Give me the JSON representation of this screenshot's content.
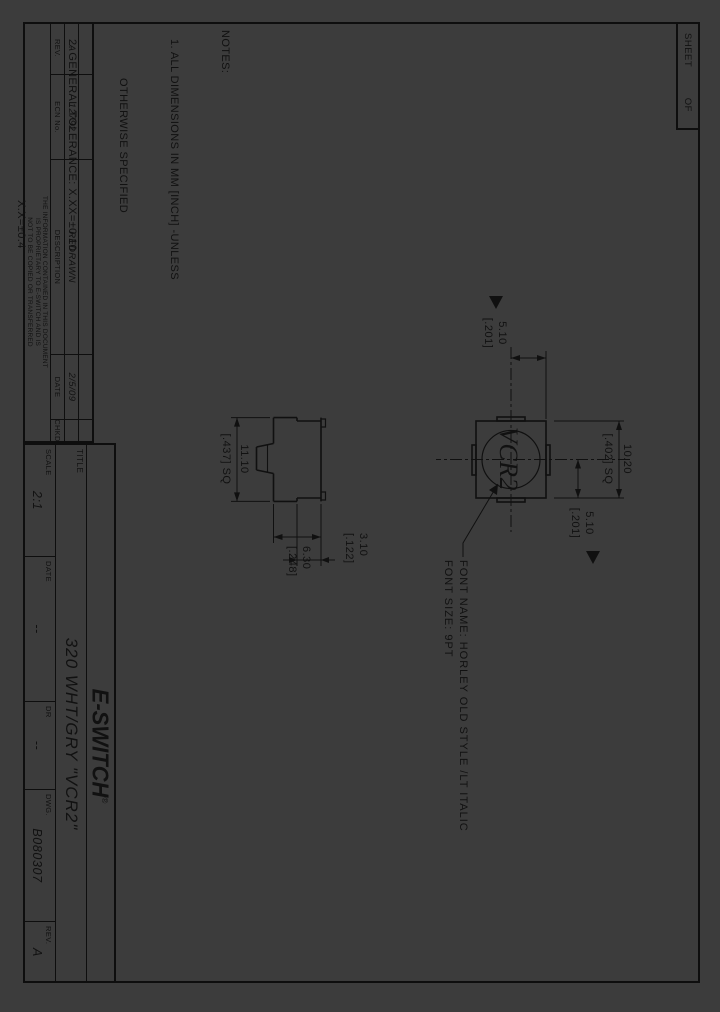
{
  "colors": {
    "background": "#3c3c3c",
    "line": "#0e0e0e",
    "text": "#111111"
  },
  "sheet_box": {
    "sheet": "SHEET",
    "of": "OF"
  },
  "notes": {
    "heading": "NOTES:",
    "line1": "1. ALL DIMENSIONS IN MM [INCH] -UNLESS",
    "line1b": "OTHERWISE SPECIFIED",
    "line2": "2. GENERAL TOLERANCE: X.XX=±0.10",
    "line2b": "X.X=±0.4",
    "line3": "3. USES CAP: (PART NO.) B040001",
    "line4": "4. CAP LETTERING:  GREY",
    "line5": "5. GRAPHICS TO BE CENTERED ON BUTTON",
    "line5b": "WITHIN [±.010] TO 10.20 DIMENSION."
  },
  "top_view": {
    "button_text": "VCR2",
    "dim_overall_mm": "10.20",
    "dim_overall_in": "[.402] SQ",
    "dim_center_left_mm": "5.10",
    "dim_center_left_in": "[.201]",
    "dim_center_top_mm": "5.10",
    "dim_center_top_in": "[.201]"
  },
  "side_view": {
    "dim_width_mm": "11.10",
    "dim_width_in": "[.437] SQ",
    "dim_height_mm": "6.30",
    "dim_height_in": "[.248]",
    "dim_top_mm": "3.10",
    "dim_top_in": "[.122]"
  },
  "font_note": {
    "line1": "FONT NAME: HORLEY OLD STYLE /LT ITALIC",
    "line2": "FONT SIZE: 9PT"
  },
  "revision_table": {
    "headers": [
      "REV.",
      "ECN No.",
      "DESCRIPTION",
      "DATE",
      "CHKD"
    ],
    "row": {
      "rev": "A",
      "ecn": "12792",
      "description": "REDRAWN",
      "date": "2/5/09",
      "chkd": ""
    }
  },
  "proprietary": {
    "line1": "THE INFORMATION CONTAINED IN THIS DOCUMENT",
    "line2": "IS PROPRIETARY TO E-SWITCH AND IS",
    "line3": "NOT TO BE COPIED OR TRANSFERRED"
  },
  "title_block": {
    "title_label": "TITLE",
    "title": "320 WHT/GRY \"VCR2\"",
    "logo": "E-SWITCH",
    "logo_reg": "®",
    "fields": [
      {
        "label": "SCALE",
        "value": "2:1"
      },
      {
        "label": "DATE",
        "value": "--"
      },
      {
        "label": "DR",
        "value": "--"
      },
      {
        "label": "DWG.",
        "value": "B080307"
      },
      {
        "label": "REV.",
        "value": "A"
      }
    ]
  }
}
